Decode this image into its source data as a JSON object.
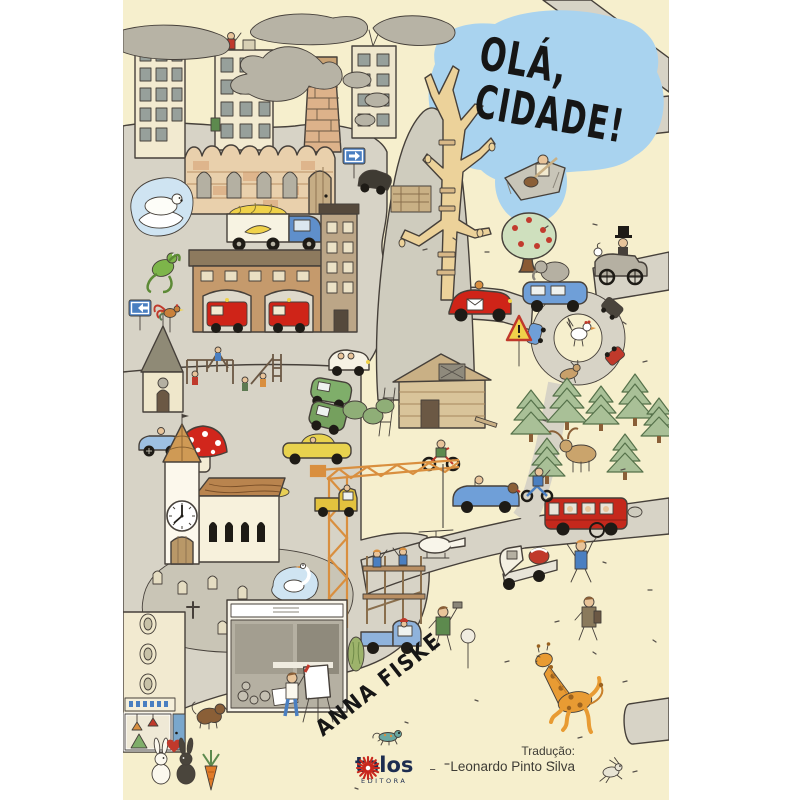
{
  "cover": {
    "title": {
      "line1": "OLÁ,",
      "line2": "CIDADE!"
    },
    "author": "ANNA FISKE",
    "publisher": {
      "name": "telos",
      "subtitle": "EDITORA",
      "dash": "–"
    },
    "translation": {
      "label": "Tradução:",
      "name": "Leonardo Pinto Silva"
    },
    "colors": {
      "background": "#f6efcd",
      "sky_blob": "#a9d3ef",
      "road_gray": "#d7d3c6",
      "smoke_gray": "#b7b3a5",
      "outline": "#46403a",
      "title_text": "#161616",
      "publisher_navy": "#1d2d50",
      "publisher_star_red": "#c9281e",
      "fire_truck_red": "#cf2418",
      "bus_red": "#c5281c",
      "mushroom_red": "#d1261c",
      "giraffe_orange": "#e89b33",
      "pine_green": "#a9c097",
      "pond_blue": "#cfe4f2"
    },
    "scene_elements": [
      "smoke-clouds",
      "apartment-buildings",
      "factory-chimney",
      "castle-brick-wall",
      "polar-bear-pond",
      "banana-truck",
      "fire-station",
      "fire-trucks",
      "trash-bin",
      "frog",
      "arrow-signs",
      "rock-hill",
      "dead-tree",
      "flying-carpet-man",
      "apple-tree",
      "top-hat-driver-car",
      "red-sports-car",
      "blue-sedan-with-elephant",
      "roundabout-loop",
      "chicken",
      "warning-sign",
      "construction-hut",
      "motorbike-kid",
      "pine-forest",
      "moose",
      "gothic-house",
      "rooster-pole",
      "playground",
      "white-car",
      "green-wagon",
      "green-suv",
      "race-car",
      "yellow-car",
      "giant-mushroom",
      "small-mushrooms",
      "church-clock-tower",
      "graveyard",
      "swan-pond",
      "tower-crane",
      "hanging-helicopter",
      "yellow-truck",
      "scaffolding",
      "blue-pickup",
      "red-bus",
      "convertible-with-dog",
      "motorcycle-rider",
      "tow-truck",
      "unicycle-man",
      "walking-man",
      "hammer-man",
      "corner-shop",
      "display-window-shop",
      "painter-at-easel",
      "cypress",
      "brown-dog",
      "rabbits-in-love",
      "heart",
      "carrot",
      "giraffe",
      "running-bunny",
      "chameleon"
    ]
  }
}
